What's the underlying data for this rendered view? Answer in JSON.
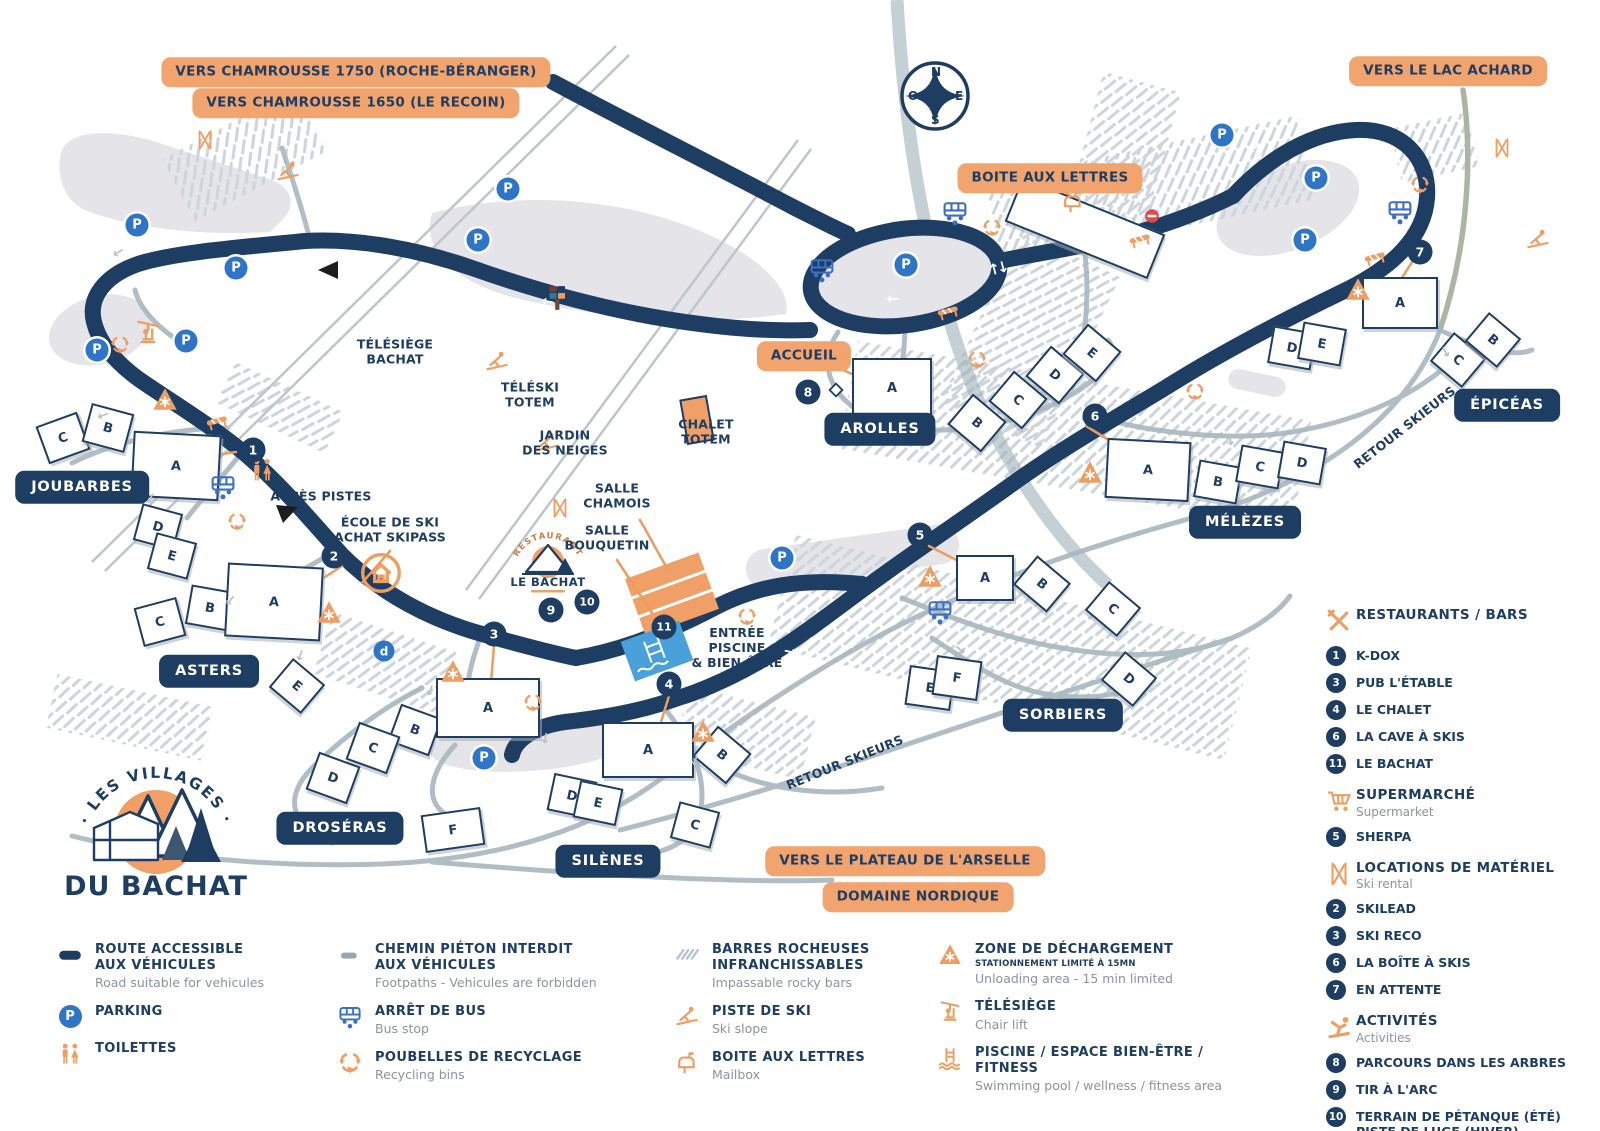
{
  "colors": {
    "navy": "#1d3d63",
    "banner_orange": "#f2a46f",
    "icon_orange": "#ee9e63",
    "parking_blue": "#2e75c8",
    "path_gray": "#aab8bf",
    "pool_blue": "#4aa0d8",
    "red": "#e04a4a"
  },
  "logo": {
    "arc": "· LES VILLAGES ·",
    "name": "DU BACHAT"
  },
  "mini_logo": {
    "arc": "RESTAURANT",
    "name": "LE BACHAT"
  },
  "map": {
    "compass": {
      "n": "N",
      "s": "S",
      "e": "E",
      "o": "O"
    },
    "parking_letter": "P",
    "banners": [
      [
        "VERS CHAMROUSSE 1750 (ROCHE-BÉRANGER)",
        356,
        72
      ],
      [
        "VERS CHAMROUSSE 1650 (LE RECOIN)",
        356,
        103
      ],
      [
        "VERS LE LAC ACHARD",
        1448,
        71
      ],
      [
        "BOITE AUX LETTRES",
        1050,
        178
      ],
      [
        "ACCUEIL",
        804,
        356
      ],
      [
        "VERS LE PLATEAU DE L'ARSELLE",
        905,
        861
      ],
      [
        "DOMAINE NORDIQUE",
        918,
        897
      ]
    ],
    "villages": [
      [
        "JOUBARBES",
        82,
        487
      ],
      [
        "ASTERS",
        209,
        671
      ],
      [
        "DROSÉRAS",
        340,
        828
      ],
      [
        "SILÈNES",
        608,
        861
      ],
      [
        "SORBIERS",
        1063,
        715
      ],
      [
        "MÉLÈZES",
        1245,
        522
      ],
      [
        "ÉPICÉAS",
        1507,
        405
      ],
      [
        "AROLLES",
        880,
        429
      ]
    ],
    "places": [
      [
        "TÉLÉSIÈGE\nBACHAT",
        395,
        352,
        0
      ],
      [
        "TÉLÉSKI\nTOTEM",
        530,
        395,
        0
      ],
      [
        "JARDIN\nDES NEIGES",
        565,
        443,
        0
      ],
      [
        "CHALET\nTOTEM",
        706,
        432,
        0
      ],
      [
        "SALLE\nCHAMOIS",
        617,
        496,
        0
      ],
      [
        "SALLE\nBOUQUETIN",
        607,
        538,
        0
      ],
      [
        "ENTRÉE\nPISCINE\n& BIEN-ÊTRE",
        737,
        648,
        0
      ],
      [
        "ACCÈS PISTES",
        321,
        497,
        0
      ],
      [
        "ÉCOLE DE SKI\nACHAT SKIPASS",
        390,
        530,
        0
      ],
      [
        "RETOUR SKIEURS",
        1405,
        428,
        -38
      ],
      [
        "RETOUR SKIEURS",
        845,
        763,
        -22
      ]
    ],
    "numbers": [
      [
        "1",
        253,
        450
      ],
      [
        "2",
        334,
        556
      ],
      [
        "3",
        494,
        634
      ],
      [
        "4",
        669,
        684
      ],
      [
        "5",
        920,
        535
      ],
      [
        "6",
        1095,
        416
      ],
      [
        "7",
        1420,
        252
      ],
      [
        "8",
        808,
        392
      ],
      [
        "9",
        551,
        610
      ],
      [
        "10",
        587,
        602
      ],
      [
        "11",
        664,
        627
      ]
    ],
    "parkings": [
      [
        137,
        225
      ],
      [
        236,
        268
      ],
      [
        186,
        341
      ],
      [
        97,
        350
      ],
      [
        508,
        189
      ],
      [
        478,
        240
      ],
      [
        906,
        265
      ],
      [
        1222,
        135
      ],
      [
        1316,
        178
      ],
      [
        1305,
        240
      ],
      [
        782,
        558
      ],
      [
        484,
        758
      ]
    ],
    "letter_markers": [
      [
        "d",
        384,
        651
      ]
    ],
    "buildings": [
      [
        "C",
        63,
        438,
        40,
        36,
        -20
      ],
      [
        "B",
        108,
        428,
        40,
        36,
        15
      ],
      [
        "A",
        176,
        466,
        84,
        62,
        3
      ],
      [
        "D",
        158,
        527,
        38,
        34,
        15
      ],
      [
        "E",
        172,
        556,
        38,
        34,
        15
      ],
      [
        "C",
        160,
        622,
        40,
        36,
        -15
      ],
      [
        "B",
        210,
        608,
        40,
        36,
        10
      ],
      [
        "A",
        274,
        602,
        92,
        70,
        3
      ],
      [
        "E",
        297,
        686,
        38,
        34,
        40
      ],
      [
        "B",
        415,
        730,
        40,
        36,
        20
      ],
      [
        "C",
        373,
        748,
        40,
        36,
        20
      ],
      [
        "D",
        333,
        778,
        40,
        36,
        20
      ],
      [
        "F",
        453,
        830,
        56,
        34,
        -8
      ],
      [
        "A",
        488,
        708,
        100,
        56,
        0
      ],
      [
        "A",
        648,
        750,
        88,
        52,
        0
      ],
      [
        "D",
        572,
        796,
        40,
        34,
        12
      ],
      [
        "E",
        598,
        803,
        40,
        34,
        12
      ],
      [
        "C",
        695,
        825,
        38,
        34,
        15
      ],
      [
        "B",
        722,
        755,
        40,
        36,
        40
      ],
      [
        "A",
        985,
        578,
        54,
        42,
        0
      ],
      [
        "B",
        1042,
        584,
        40,
        34,
        40
      ],
      [
        "E",
        930,
        688,
        42,
        36,
        8
      ],
      [
        "F",
        957,
        678,
        42,
        36,
        8
      ],
      [
        "C",
        1113,
        609,
        38,
        34,
        40
      ],
      [
        "D",
        1129,
        679,
        38,
        34,
        40
      ],
      [
        "A",
        892,
        388,
        76,
        56,
        0
      ],
      [
        "B",
        977,
        423,
        40,
        36,
        40
      ],
      [
        "C",
        1018,
        400,
        40,
        36,
        40
      ],
      [
        "D",
        1055,
        375,
        40,
        36,
        40
      ],
      [
        "E",
        1092,
        353,
        40,
        36,
        40
      ],
      [
        "",
        1085,
        228,
        150,
        44,
        22
      ],
      [
        "A",
        1400,
        303,
        72,
        48,
        0
      ],
      [
        "D",
        1292,
        348,
        40,
        34,
        10
      ],
      [
        "E",
        1322,
        344,
        40,
        34,
        10
      ],
      [
        "C",
        1458,
        360,
        38,
        34,
        40
      ],
      [
        "B",
        1493,
        340,
        38,
        34,
        40
      ],
      [
        "A",
        1148,
        470,
        80,
        56,
        3
      ],
      [
        "B",
        1218,
        482,
        40,
        34,
        10
      ],
      [
        "C",
        1260,
        467,
        40,
        34,
        10
      ],
      [
        "D",
        1302,
        463,
        40,
        34,
        10
      ]
    ],
    "icons": [
      [
        "recycle",
        120,
        345
      ],
      [
        "recycle",
        237,
        522
      ],
      [
        "recycle",
        533,
        703
      ],
      [
        "recycle",
        747,
        617
      ],
      [
        "recycle",
        992,
        228
      ],
      [
        "recycle",
        977,
        360
      ],
      [
        "recycle",
        1195,
        392
      ],
      [
        "recycle",
        1420,
        185
      ],
      [
        "bus",
        822,
        270
      ],
      [
        "bus",
        955,
        213
      ],
      [
        "bus",
        223,
        487
      ],
      [
        "bus",
        940,
        612
      ],
      [
        "bus",
        1400,
        212
      ],
      [
        "toilets",
        262,
        470
      ],
      [
        "mailbox",
        1073,
        202
      ],
      [
        "gate",
        948,
        312
      ],
      [
        "gate",
        1140,
        240
      ],
      [
        "gate",
        1375,
        258
      ],
      [
        "gate",
        217,
        422
      ],
      [
        "unload",
        165,
        400
      ],
      [
        "unload",
        329,
        613
      ],
      [
        "unload",
        453,
        672
      ],
      [
        "unload",
        703,
        732
      ],
      [
        "unload",
        930,
        577
      ],
      [
        "unload",
        1090,
        473
      ],
      [
        "unload",
        1358,
        290
      ],
      [
        "school",
        381,
        573
      ],
      [
        "chairlift",
        148,
        333
      ],
      [
        "skier",
        288,
        172
      ],
      [
        "skier",
        497,
        362
      ],
      [
        "skier",
        547,
        443
      ],
      [
        "skier",
        1538,
        240
      ],
      [
        "skis",
        205,
        140
      ],
      [
        "skis",
        560,
        508
      ],
      [
        "skis",
        1502,
        148
      ],
      [
        "noentry",
        1152,
        216
      ],
      [
        "diamond",
        836,
        390
      ],
      [
        "totem",
        558,
        298
      ]
    ],
    "arrows_white": [
      [
        665,
        123,
        -28,
        "d"
      ],
      [
        548,
        302,
        8,
        "l"
      ],
      [
        893,
        299,
        0,
        "l"
      ],
      [
        998,
        268,
        75,
        "d"
      ],
      [
        1100,
        247,
        -12,
        "d"
      ],
      [
        1255,
        148,
        -20,
        "l"
      ],
      [
        1335,
        282,
        -25,
        "r"
      ],
      [
        700,
        643,
        0,
        "l"
      ],
      [
        790,
        652,
        12,
        "r"
      ]
    ],
    "arrows_gray": [
      [
        118,
        252,
        150
      ],
      [
        103,
        415,
        160
      ],
      [
        150,
        498,
        120
      ],
      [
        230,
        600,
        130
      ],
      [
        300,
        655,
        110
      ],
      [
        430,
        690,
        110
      ],
      [
        545,
        738,
        100
      ],
      [
        695,
        760,
        110
      ],
      [
        960,
        650,
        40
      ],
      [
        1230,
        440,
        80
      ],
      [
        1445,
        352,
        60
      ]
    ]
  },
  "sidebar": {
    "sections": [
      {
        "icon": "restaurant",
        "title": "RESTAURANTS / BARS",
        "subtitle": "",
        "items": [
          [
            "1",
            "K-DOX"
          ],
          [
            "3",
            "PUB L'ÉTABLE"
          ],
          [
            "4",
            "LE CHALET"
          ],
          [
            "6",
            "LA CAVE À SKIS"
          ],
          [
            "11",
            "LE BACHAT"
          ]
        ]
      },
      {
        "icon": "cart",
        "title": "SUPERMARCHÉ",
        "subtitle": "Supermarket",
        "items": [
          [
            "5",
            "SHERPA"
          ]
        ]
      },
      {
        "icon": "skis",
        "title": "LOCATIONS DE MATÉRIEL",
        "subtitle": "Ski rental",
        "items": [
          [
            "2",
            "SKILEAD"
          ],
          [
            "3",
            "SKI RECO"
          ],
          [
            "6",
            "LA BOÎTE À SKIS"
          ],
          [
            "7",
            "EN ATTENTE"
          ]
        ]
      },
      {
        "icon": "activity",
        "title": "ACTIVITÉS",
        "subtitle": "Activities",
        "items": [
          [
            "8",
            "PARCOURS DANS LES ARBRES"
          ],
          [
            "9",
            "TIR À L'ARC"
          ],
          [
            "10",
            "TERRAIN DE PÉTANQUE (ÉTÉ)\nPISTE DE LUGE (HIVER)"
          ]
        ]
      }
    ]
  },
  "legend": {
    "columns": [
      {
        "x": 45,
        "w": 275,
        "items": [
          {
            "i": "road",
            "t": "ROUTE ACCESSIBLE\nAUX VÉHICULES",
            "sub": "Road suitable for vehicules"
          },
          {
            "i": "parking",
            "t": "PARKING"
          },
          {
            "i": "toilets",
            "t": "TOILETTES"
          }
        ]
      },
      {
        "x": 325,
        "w": 300,
        "items": [
          {
            "i": "footpath",
            "t": "CHEMIN PIÉTON INTERDIT\nAUX VÉHICULES",
            "sub": "Footpaths - Vehicules are forbidden"
          },
          {
            "i": "bus",
            "t": "ARRÊT DE BUS",
            "sub": "Bus stop"
          },
          {
            "i": "recycle",
            "t": "POUBELLES DE RECYCLAGE",
            "sub": "Recycling bins"
          }
        ]
      },
      {
        "x": 662,
        "w": 265,
        "items": [
          {
            "i": "rocks",
            "t": "BARRES ROCHEUSES\nINFRANCHISSABLES",
            "sub": "Impassable rocky bars"
          },
          {
            "i": "skier",
            "t": "PISTE DE SKI",
            "sub": "Ski slope"
          },
          {
            "i": "mailbox",
            "t": "BOITE AUX LETTRES",
            "sub": "Mailbox"
          }
        ]
      },
      {
        "x": 925,
        "w": 345,
        "items": [
          {
            "i": "unload",
            "t": "ZONE DE DÉCHARGEMENT",
            "s": "STATIONNEMENT LIMITÉ À 15MN",
            "sub": "Unloading area - 15 min limited"
          },
          {
            "i": "chairlift",
            "t": "TÉLÉSIÈGE",
            "sub": "Chair lift"
          },
          {
            "i": "pool",
            "t": "PISCINE / ESPACE BIEN-ÊTRE / FITNESS",
            "sub": "Swimming pool / wellness / fitness area"
          }
        ]
      }
    ]
  }
}
